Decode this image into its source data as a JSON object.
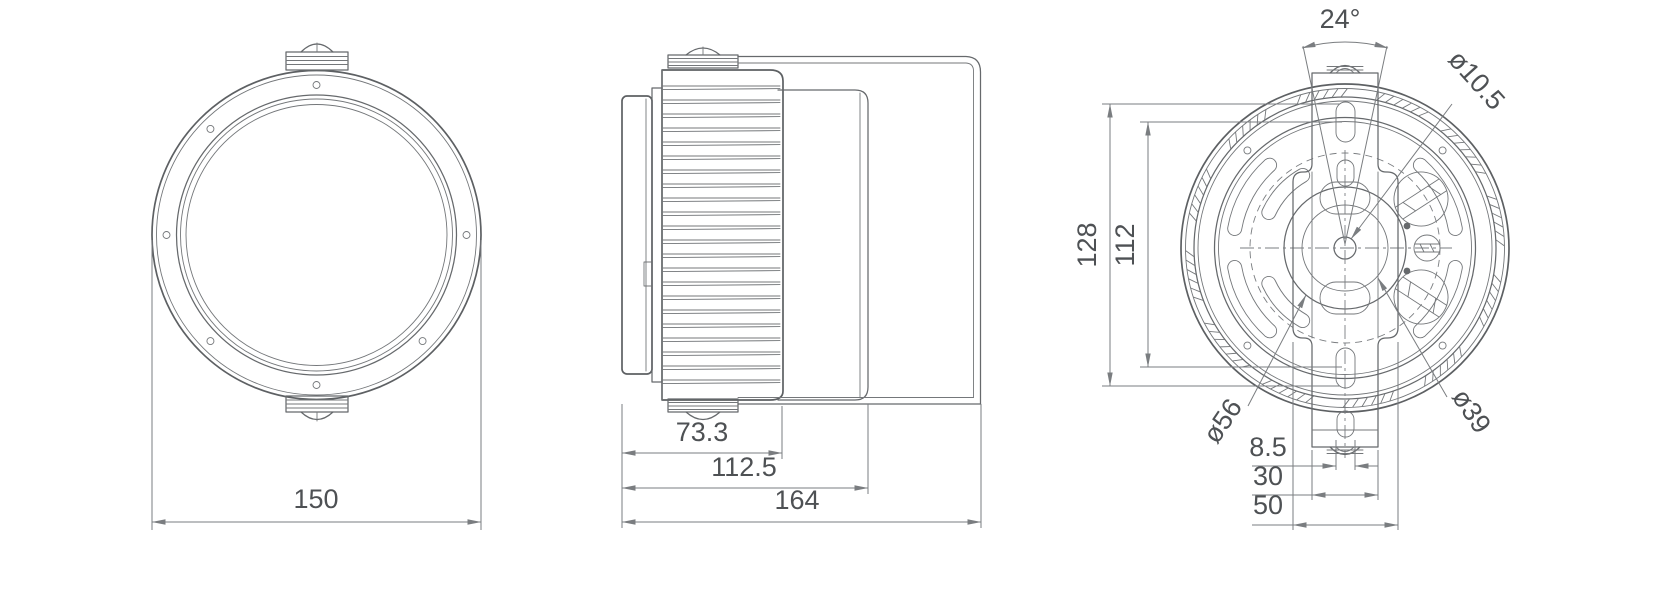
{
  "drawing": {
    "front_view": {
      "dim_outer_diameter": "150"
    },
    "side_view": {
      "dim_front_section": "73.3",
      "dim_body_length": "112.5",
      "dim_overall_length": "164"
    },
    "rear_view": {
      "dim_bracket_angle": "24°",
      "dim_center_hole": "ø10.5",
      "dim_boss_outer": "ø56",
      "dim_boss_inner": "ø39",
      "dim_slot_width": "8.5",
      "dim_bracket_width": "30",
      "dim_bracket_plate_width": "50",
      "dim_slot_outer_span": "128",
      "dim_slot_center_span": "112"
    }
  }
}
